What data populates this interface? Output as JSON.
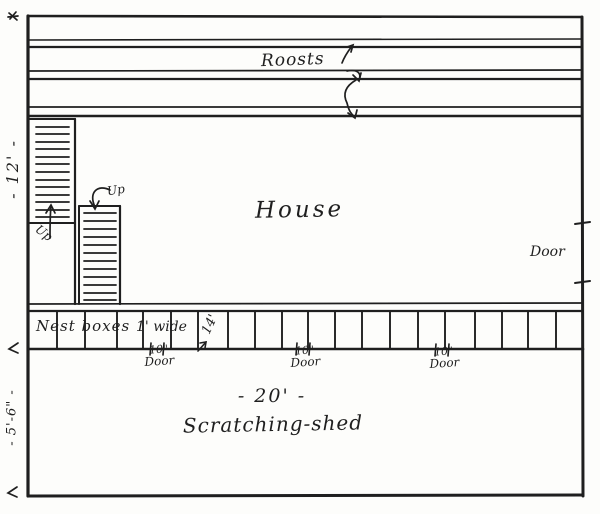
{
  "diagram": {
    "type": "hand-drawn poultry house floor plan",
    "colors": {
      "ink": "#1f1f1f",
      "paper": "#fdfdfb"
    },
    "roosts_label": "Roosts",
    "house_label": "House",
    "right_door_label": "Door",
    "nest_boxes_label": "Nest boxes",
    "nest_width_label": "1' wide",
    "fourteen_label": "14'",
    "house_depth_dim": "- 12' -",
    "shed_depth_dim": "- 5'-6\" -",
    "shed_width_dim": "- 20' -",
    "shed_label": "Scratching-shed",
    "up_label_1": "Up",
    "up_label_2": "Up",
    "small_doors": [
      {
        "size": "10\"",
        "word": "Door"
      },
      {
        "size": "10\"",
        "word": "Door"
      },
      {
        "size": "10\"",
        "word": "Door"
      }
    ]
  }
}
